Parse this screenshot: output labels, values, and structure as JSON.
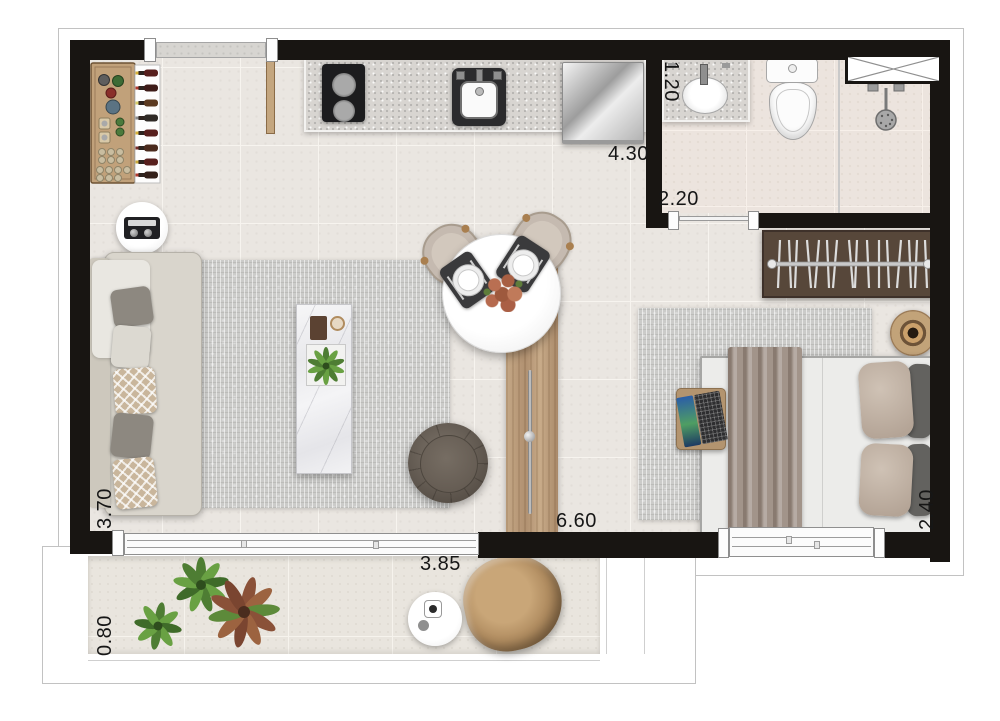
{
  "plan": {
    "type": "studio-apartment-floor-plan",
    "dimension_labels": {
      "kitchen_length": "4.30",
      "hall_width": "2.20",
      "bathroom_width": "1.20",
      "living_width": "3.70",
      "interior_length": "6.60",
      "bedroom_width": "2.40",
      "balcony_length": "3.85",
      "balcony_depth": "0.80"
    },
    "rooms": [
      "kitchen",
      "bathroom",
      "living-dining",
      "bedroom",
      "hall",
      "balcony"
    ],
    "furniture": [
      "bar-cabinet-with-bottles",
      "radio-side-table",
      "sofa-with-pillows",
      "living-rug",
      "marble-coffee-table",
      "round-dining-table",
      "dining-chairs",
      "place-settings",
      "flower-centerpiece",
      "pouf",
      "wood-sliding-door",
      "cooktop",
      "kitchen-sink",
      "refrigerator",
      "entry-door",
      "vanity-sink",
      "toilet",
      "shower",
      "ventilation-shaft",
      "wardrobe-with-hangers",
      "bedroom-rug",
      "double-bed",
      "throw-blanket",
      "pillows",
      "laptop-side-table",
      "round-tray-stool",
      "balcony-lounge-chair",
      "balcony-side-table",
      "balcony-plants",
      "sliding-glass-door",
      "bedroom-window"
    ],
    "colors": {
      "wall": "#181512",
      "floor": "#eae6e1",
      "bath_floor": "#ece4de",
      "rug": "#cbcbc9",
      "wood": "#b99b77",
      "granite": "#d8d5d1",
      "wardrobe": "#57473a"
    }
  }
}
